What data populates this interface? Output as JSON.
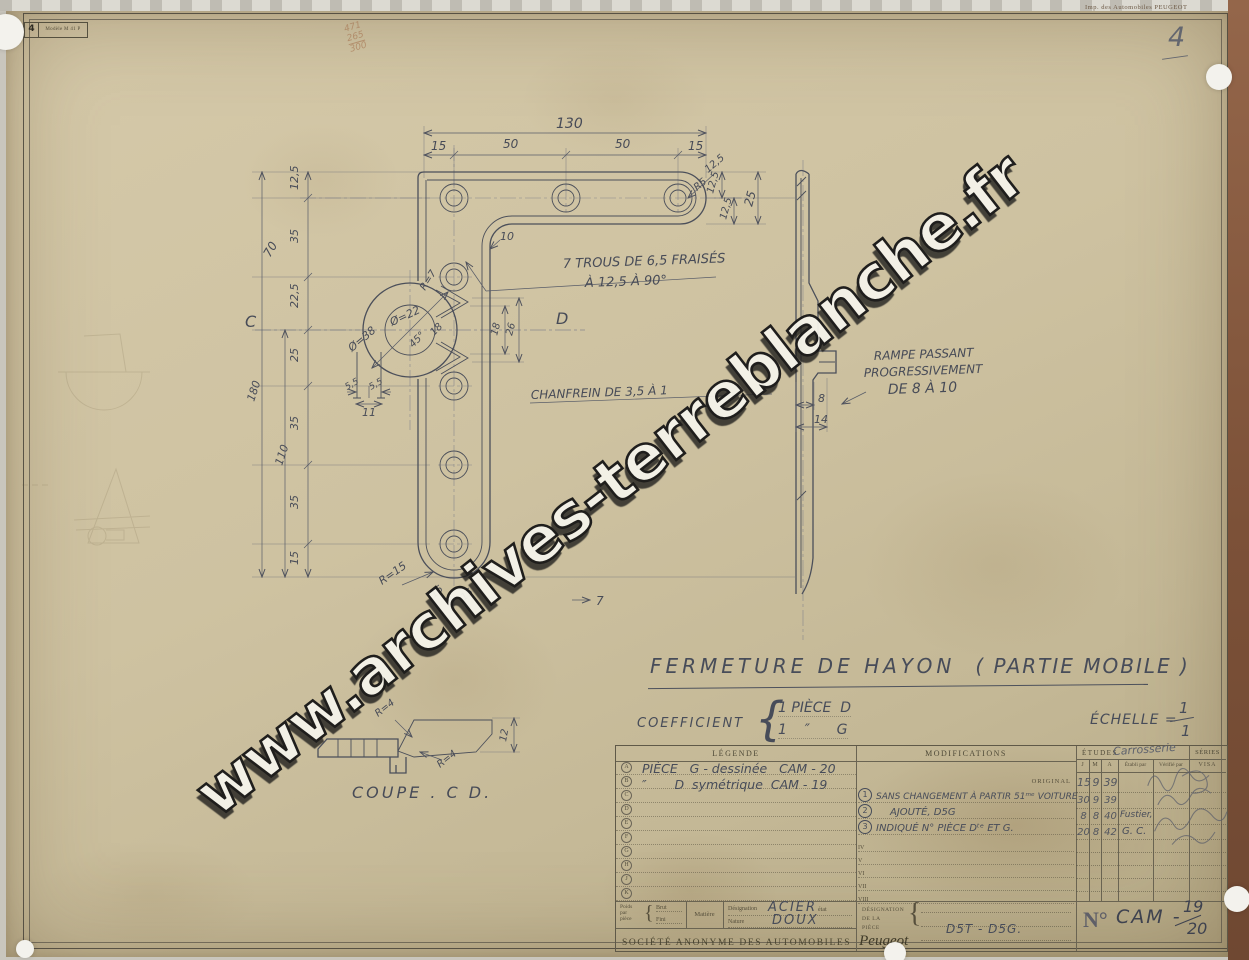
{
  "stamps": {
    "model_number": "4",
    "model_label": "Modèle M 41 P",
    "printer": "Imp. des Automobiles PEUGEOT",
    "page_number": "4",
    "pencil_note": [
      "471",
      "265",
      "300"
    ]
  },
  "title_block": {
    "title": "FERMETURE DE HAYON",
    "subtitle": "( PARTIE MOBILE )",
    "coefficient_label": "COEFFICIENT",
    "brace": "{",
    "coefficient_line1": "1 PIÈCE  D",
    "coefficient_line2": "1    ″      G",
    "scale_label": "ÉCHELLE =",
    "scale_numerator": "1",
    "scale_denominator": "1"
  },
  "drawing": {
    "view_labels": {
      "c": "C",
      "d": "D"
    },
    "notes": {
      "holes_line1": "7 TROUS DE 6,5 FRAISÉS",
      "holes_line2": "À 12,5 À 90°",
      "chamfer": "CHANFREIN DE 3,5 À 1",
      "ramp_line1": "RAMPE PASSANT",
      "ramp_line2": "PROGRESSIVEMENT",
      "ramp_line3": "DE 8 À 10",
      "coupe": "COUPE . C D."
    },
    "dims": {
      "total_width": "130",
      "seg1": "15",
      "seg2": "50",
      "seg3": "50",
      "seg4": "15",
      "corner_r": "R5",
      "diag_offset": "12,5",
      "off1": "12,5",
      "off2": "12,5",
      "end_offset": "25",
      "left1": "12,5",
      "left2": "35",
      "left3": "22,5",
      "left4": "25",
      "left5": "35",
      "left6": "35",
      "left7": "15",
      "cum1": "70",
      "cum2": "110",
      "total_height": "180",
      "fillet": "10",
      "cam_outer": "Ø=38",
      "cam_inner": "Ø=22",
      "claw_r": "R=7",
      "claw_angle": "45°",
      "claw_w": "18",
      "slot_l": "5,5",
      "slot_r": "5,5",
      "slot_total": "11",
      "web1": "18",
      "web2": "26",
      "cap_r": "R=15",
      "cap1": "15",
      "cap2": "15",
      "thickness": "7",
      "ramp_a": "8",
      "ramp_b": "14",
      "coupe_r1": "R=4",
      "coupe_r2": "R=4",
      "coupe_h": "12"
    }
  },
  "table": {
    "legend": {
      "header": "LÉGENDE",
      "rows": [
        {
          "key": "A",
          "text": "PIÈCE   G - dessinée   CAM - 20"
        },
        {
          "key": "B",
          "text": "″       D  symétrique  CAM - 19"
        },
        {
          "key": "C"
        },
        {
          "key": "D"
        },
        {
          "key": "E"
        },
        {
          "key": "F"
        },
        {
          "key": "G"
        },
        {
          "key": "H"
        },
        {
          "key": "J"
        },
        {
          "key": "K"
        }
      ]
    },
    "modifications": {
      "header": "MODIFICATIONS",
      "original": "ORIGINAL",
      "entries": [
        {
          "num": "1",
          "text": "SANS CHANGEMENT À PARTIR 51ᵐᵉ VOITURE"
        },
        {
          "num": "2",
          "text": "AJOUTÉ, D5G"
        },
        {
          "num": "3",
          "text": "INDIQUÉ N° PIÈCE Dᵗᵉ ET G."
        }
      ],
      "roman": [
        "IV",
        "V",
        "VI",
        "VII",
        "VIII"
      ]
    },
    "approvals": {
      "etudes_header": "ÉTUDES",
      "etudes_hw": "Carrosserie",
      "series_header": "SÉRIES",
      "col_j": "J",
      "col_m": "M",
      "col_a": "A",
      "col_etabli": "Établi par",
      "col_verifie": "Vérifié par",
      "col_visa": "VISA",
      "dates": [
        {
          "j": "15",
          "m": "9",
          "a": "39",
          "etabli": ""
        },
        {
          "j": "30",
          "m": "9",
          "a": "39",
          "etabli": ""
        },
        {
          "j": "8",
          "m": "8",
          "a": "40",
          "etabli": "Fustier,"
        },
        {
          "j": "20",
          "m": "8",
          "a": "42",
          "etabli": "G. C."
        }
      ]
    },
    "footer": {
      "poids_l1": "Poids",
      "poids_l2": "par",
      "poids_l3": "pièce",
      "brace": "{",
      "brut": "Brut",
      "fini": "Fini",
      "matiere": "Matière",
      "designation": "Désignation",
      "etat": "état",
      "nature": "Nature",
      "designation_value": "ACIER",
      "nature_value": "DOUX",
      "company": "SOCIÉTÉ ANONYME DES AUTOMOBILES",
      "brand": "Peugeot",
      "piece_l1": "DÉSIGNATION",
      "piece_l2": "DE LA",
      "piece_l3": "PIÈCE",
      "piece_brace": "{",
      "piece_value": "D5T - D5G.",
      "number_label": "N°",
      "number_value": "CAM -",
      "number_num": "19",
      "number_den": "20"
    }
  },
  "watermark": {
    "text": "www.archives-terreblanche.fr"
  }
}
